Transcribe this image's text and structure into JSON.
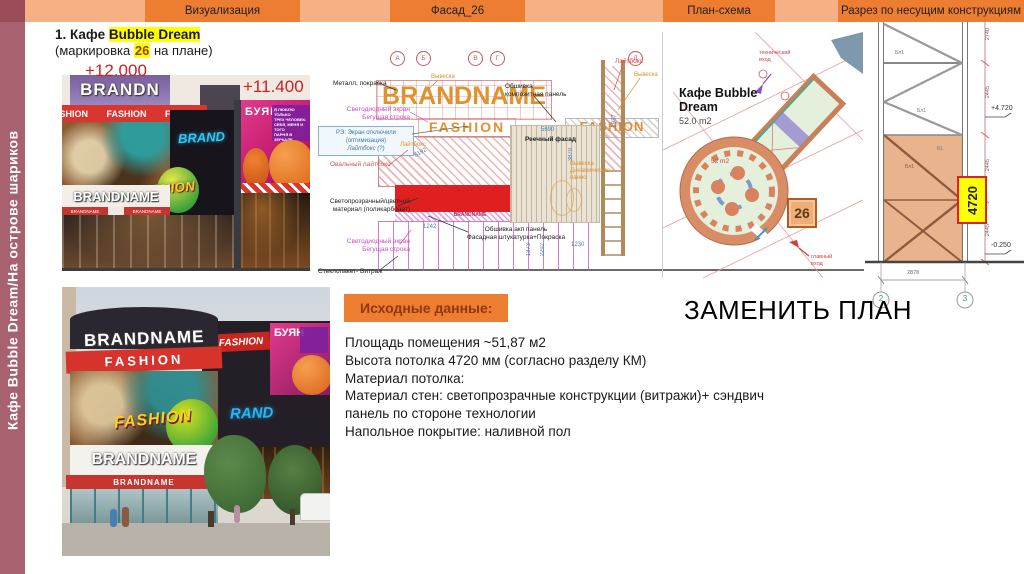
{
  "sidebar": {
    "label": "Кафе Bubble Dream/На острове шариков"
  },
  "nav": {
    "tabs": [
      {
        "label": "Визуализация"
      },
      {
        "label": "Фасад_26"
      },
      {
        "label": "План-схема"
      },
      {
        "label": "Разрез по несущим конструкциям"
      }
    ]
  },
  "title": {
    "num": "1. ",
    "prefix": "Кафе ",
    "brand": "Bubble Dream",
    "sub_pre": "(маркировка ",
    "sub_mark": "26",
    "sub_post": " на плане)"
  },
  "viz": {
    "elev_high": "+12.000",
    "elev_low": "+11.400",
    "sign_top": "BRANDN",
    "fashion1": "FASHION",
    "fashion2": "FASHION",
    "fashion3": "FASHION",
    "brand_neon": "BRAND",
    "fashion_neon": "FASHION",
    "sign_name": "BRANDNAME",
    "strip1": "BRANDNAME",
    "strip2": "BRANDNAME",
    "buyan": "БУЯН",
    "quote": [
      "Я ЛЮБЛЮ ТОЛЬКО",
      "ТРЕХ ЧЕЛОВЕК:",
      "СЕБЯ, МЕНЯ И ТОГО",
      "ПАРНЯ В ЗЕРКАЛЕ"
    ]
  },
  "facade": {
    "axes": [
      "А",
      "Б",
      "В",
      "Г",
      "Д"
    ],
    "brandname": "BRANDNAME",
    "fashion": "FASHION",
    "fashion2": "FASHION",
    "brandname_small": "BRANDNAME",
    "labels": {
      "metal": "Металл, покраска",
      "sign1": "Вывеска",
      "sign2": "Вывеска",
      "sign3a": "Вывеска",
      "sign3b": "Динамическое панно",
      "led1a": "Светодиодный экран",
      "led1b": "Бегущая строка",
      "re1": "РЭ: Экран отключили",
      "re2": "(оптимизация)",
      "re3": "Лайтбокс (?)",
      "oval": "Овальный лайтбокс",
      "poly1": "Светопрозрачный/цветной",
      "poly2": "материал (поликарбонат)",
      "led2a": "Светодиодный экран",
      "led2b": "Бегущая строка",
      "glass": "Стеклопакет- Витраж",
      "cladding1": "Обшивка",
      "cladding2": "композитная панель",
      "lightbox_red": "Лайтбокс",
      "lightbox_org": "Лайтбокс",
      "slats": "Реечный фасад",
      "acp1": "Обшивка акп панель",
      "acp2": "Фасадная штукатурка+Покраска"
    },
    "dims": {
      "d1": "5690",
      "d2": "3870",
      "d3": "6192",
      "d4": "1242",
      "d5": "1230",
      "d6": "2292",
      "d7": "1937",
      "d8": "1373"
    }
  },
  "plan": {
    "name1": "Кафе Bubble",
    "name2": "Dream",
    "area": "52.0 m2",
    "area_inner": "52 m2",
    "mark": "26",
    "tech1": "технический",
    "tech2": "вход",
    "main1": "главный",
    "main2": "вход"
  },
  "section": {
    "dim_top": "2740",
    "dim1": "2445",
    "dim2": "2445",
    "dim3": "2445",
    "elev_top": "+4.720",
    "elev_bottom": "-0.250",
    "height": "4720",
    "dim_bottom": "2878",
    "axis1": "2",
    "axis2": "3",
    "m1": "Бл1",
    "m2": "Бл1",
    "m3": "Бл1",
    "m4": "Б1"
  },
  "photo": {
    "sign_top": "BRANDNAME",
    "fashion_band": "FASHION",
    "fashion_ital": "FASHION",
    "brand_neon": "RAND",
    "name2": "BRANDNAME",
    "name3": "BRANDNAME",
    "fashion_right": "FASHION",
    "buyan": "БУЯН"
  },
  "info": {
    "heading": "Исходные данные:",
    "replace": "ЗАМЕНИТЬ ПЛАН",
    "lines": [
      "Площадь помещения ~51,87 м2",
      "Высота потолка 4720 мм (согласно разделу КМ)",
      "Материал потолка:",
      "Материал стен: светопрозрачные конструкции (витражи)+ сэндвич",
      "панель по стороне технологии",
      "Напольное покрытие: наливной пол"
    ]
  },
  "colors": {
    "accent": "#ED7D31",
    "header_bg": "#F5B183",
    "sidebar": "#A7616F",
    "highlight": "#FFFF00",
    "red_label": "#CC2222"
  }
}
